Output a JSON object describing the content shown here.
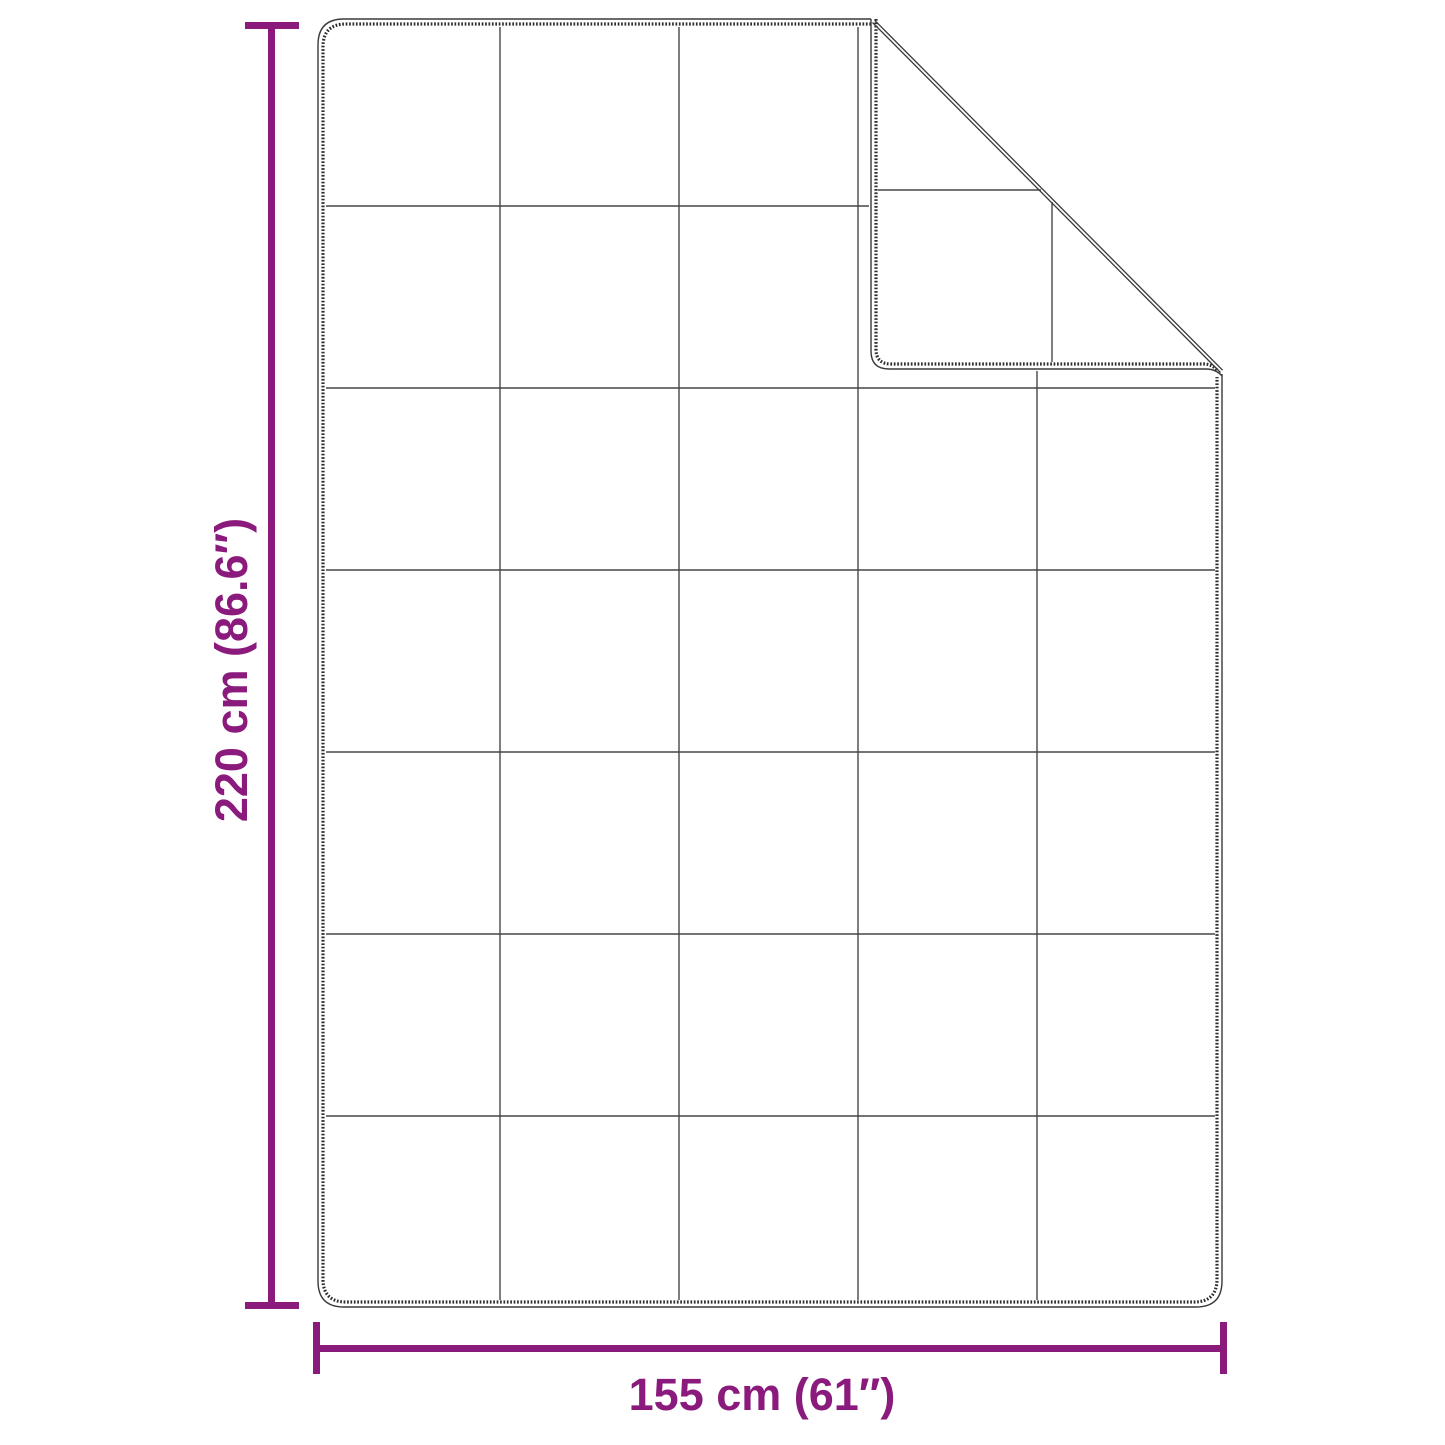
{
  "diagram": {
    "title": "Blanket size diagram",
    "subject": "quilted blanket shown flat with top-right corner folded over",
    "background_color": "#ffffff",
    "outline_color": "#3a3a3a",
    "stitch_color": "#2e2e2e",
    "grid_color": "#474747",
    "accent_color": "#8a1a7c",
    "dimensions": {
      "height": {
        "label": "220 cm (86.6″)",
        "value_cm": 220,
        "value_inches": 86.6,
        "orientation": "vertical"
      },
      "width": {
        "label": "155 cm (61″)",
        "value_cm": 155,
        "value_inches": 61,
        "orientation": "horizontal"
      }
    },
    "quilt_grid": {
      "columns": 5,
      "rows": 7
    },
    "fold": {
      "position": "top-right",
      "shows": "stitched back side of the folded corner"
    }
  }
}
